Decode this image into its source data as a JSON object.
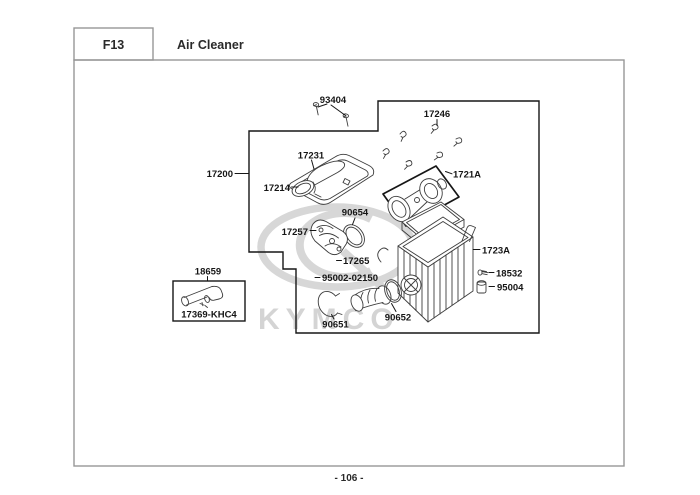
{
  "header": {
    "code": "F13",
    "title": "Air Cleaner"
  },
  "footer": {
    "page_number": "- 106 -"
  },
  "watermark": {
    "brand": "KYMCO"
  },
  "colors": {
    "ink": "#161616",
    "frame_gray": "#979797",
    "watermark_gray": "#d7d7d7",
    "background": "#ffffff"
  },
  "parts": {
    "93404": "93404",
    "17246": "17246",
    "17231": "17231",
    "17200": "17200",
    "17214": "17214",
    "1721A": "1721A",
    "90654": "90654",
    "17257": "17257",
    "17265": "17265",
    "95002-02150": "95002-02150",
    "1723A": "1723A",
    "18532": "18532",
    "95004": "95004",
    "18659": "18659",
    "17369-KHC4": "17369-KHC4",
    "90652": "90652",
    "90651": "90651"
  }
}
